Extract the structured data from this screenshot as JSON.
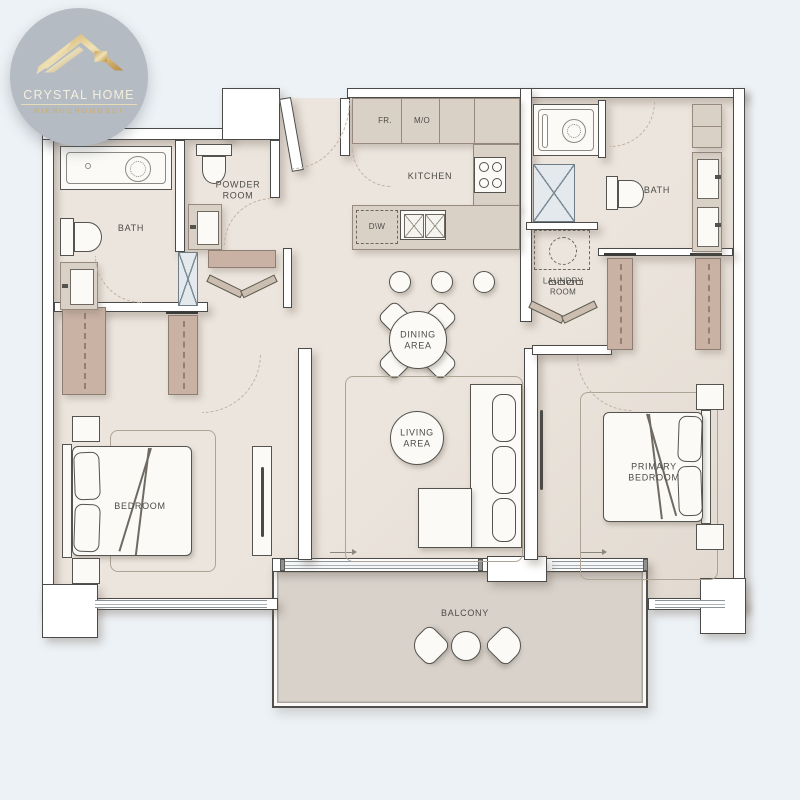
{
  "logo": {
    "title": "CRYSTAL HOME",
    "subtitle": "NIERUCHOMOŚCI",
    "icon": "house-roof-icon",
    "circle_color": "#b4bbc2",
    "gold_color": "#d3ab62"
  },
  "rooms": {
    "bath_left": {
      "label": "BATH"
    },
    "powder_room": {
      "line1": "POWDER",
      "line2": "ROOM"
    },
    "kitchen": {
      "label": "KITCHEN"
    },
    "bath_right": {
      "label": "BATH"
    },
    "laundry_room": {
      "line1": "LAUNDRY",
      "line2": "ROOM"
    },
    "dining_area": {
      "line1": "DINING",
      "line2": "AREA"
    },
    "living_area": {
      "line1": "LIVING",
      "line2": "AREA"
    },
    "bedroom": {
      "label": "BEDROOM"
    },
    "primary_bedroom": {
      "line1": "PRIMARY",
      "line2": "BEDROOM"
    },
    "balcony": {
      "label": "BALCONY"
    }
  },
  "appliances": {
    "fridge_label": "FR.",
    "microwave_oven_label": "M/O",
    "dishwasher_label": "D\\W"
  },
  "colors": {
    "background": "#edf2f6",
    "floor": "#ece5dd",
    "balcony_floor": "#d8d2cb",
    "wall": "#ffffff",
    "wall_outline": "#4a4a48",
    "cabinet": "#d9d0c6",
    "wardrobe": "#c9b2a4"
  }
}
